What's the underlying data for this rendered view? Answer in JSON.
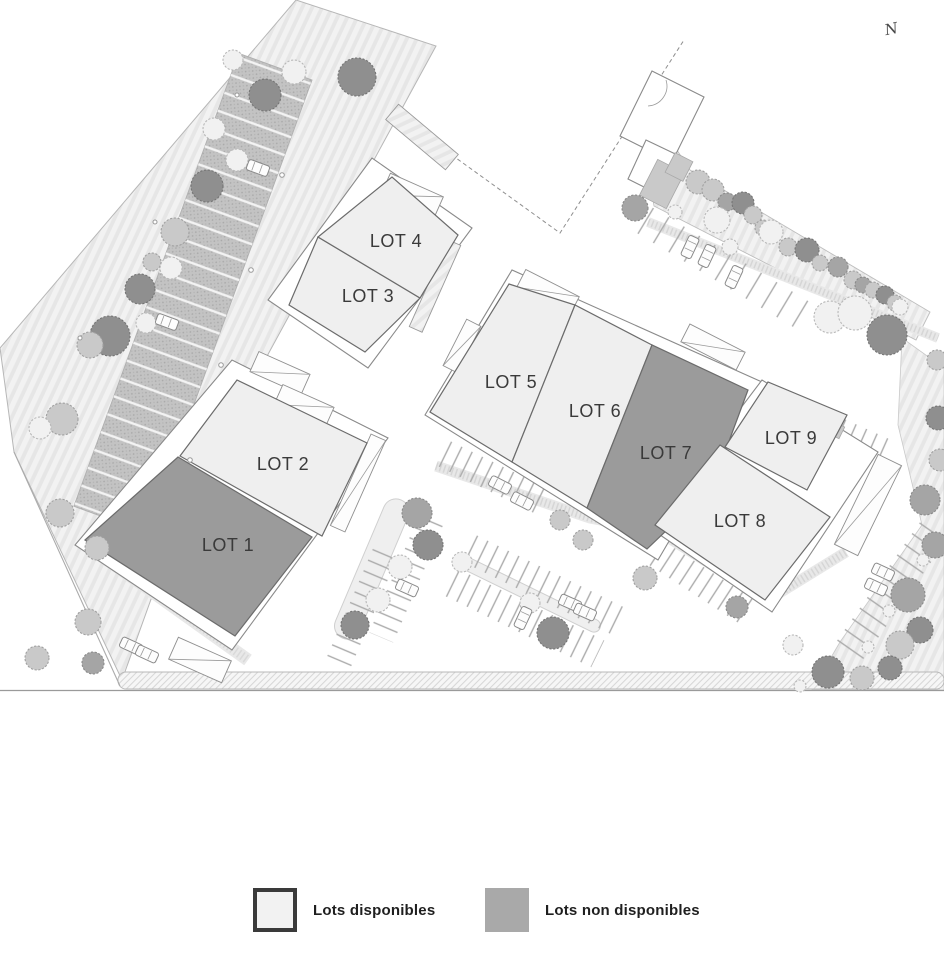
{
  "north_indicator": {
    "label": "N"
  },
  "site_plan": {
    "lots": [
      {
        "id": 1,
        "label": "LOT 1",
        "available": false
      },
      {
        "id": 2,
        "label": "LOT 2",
        "available": true
      },
      {
        "id": 3,
        "label": "LOT 3",
        "available": true
      },
      {
        "id": 4,
        "label": "LOT 4",
        "available": true
      },
      {
        "id": 5,
        "label": "LOT 5",
        "available": true
      },
      {
        "id": 6,
        "label": "LOT 6",
        "available": true
      },
      {
        "id": 7,
        "label": "LOT 7",
        "available": false
      },
      {
        "id": 8,
        "label": "LOT 8",
        "available": true
      },
      {
        "id": 9,
        "label": "LOT 9",
        "available": true
      }
    ]
  },
  "legend": {
    "items": [
      {
        "label": "Lots disponibles",
        "color": "#f2f2f2",
        "border": "#3a3a3a",
        "status": "available"
      },
      {
        "label": "Lots non disponibles",
        "color": "#a9a9a9",
        "border": "#a9a9a9",
        "status": "unavailable"
      }
    ]
  },
  "colors": {
    "available_fill": "#efefef",
    "unavailable_fill": "#9b9b9b",
    "lot_stroke": "#6b6b6b",
    "label_color": "#3a3a3a"
  }
}
